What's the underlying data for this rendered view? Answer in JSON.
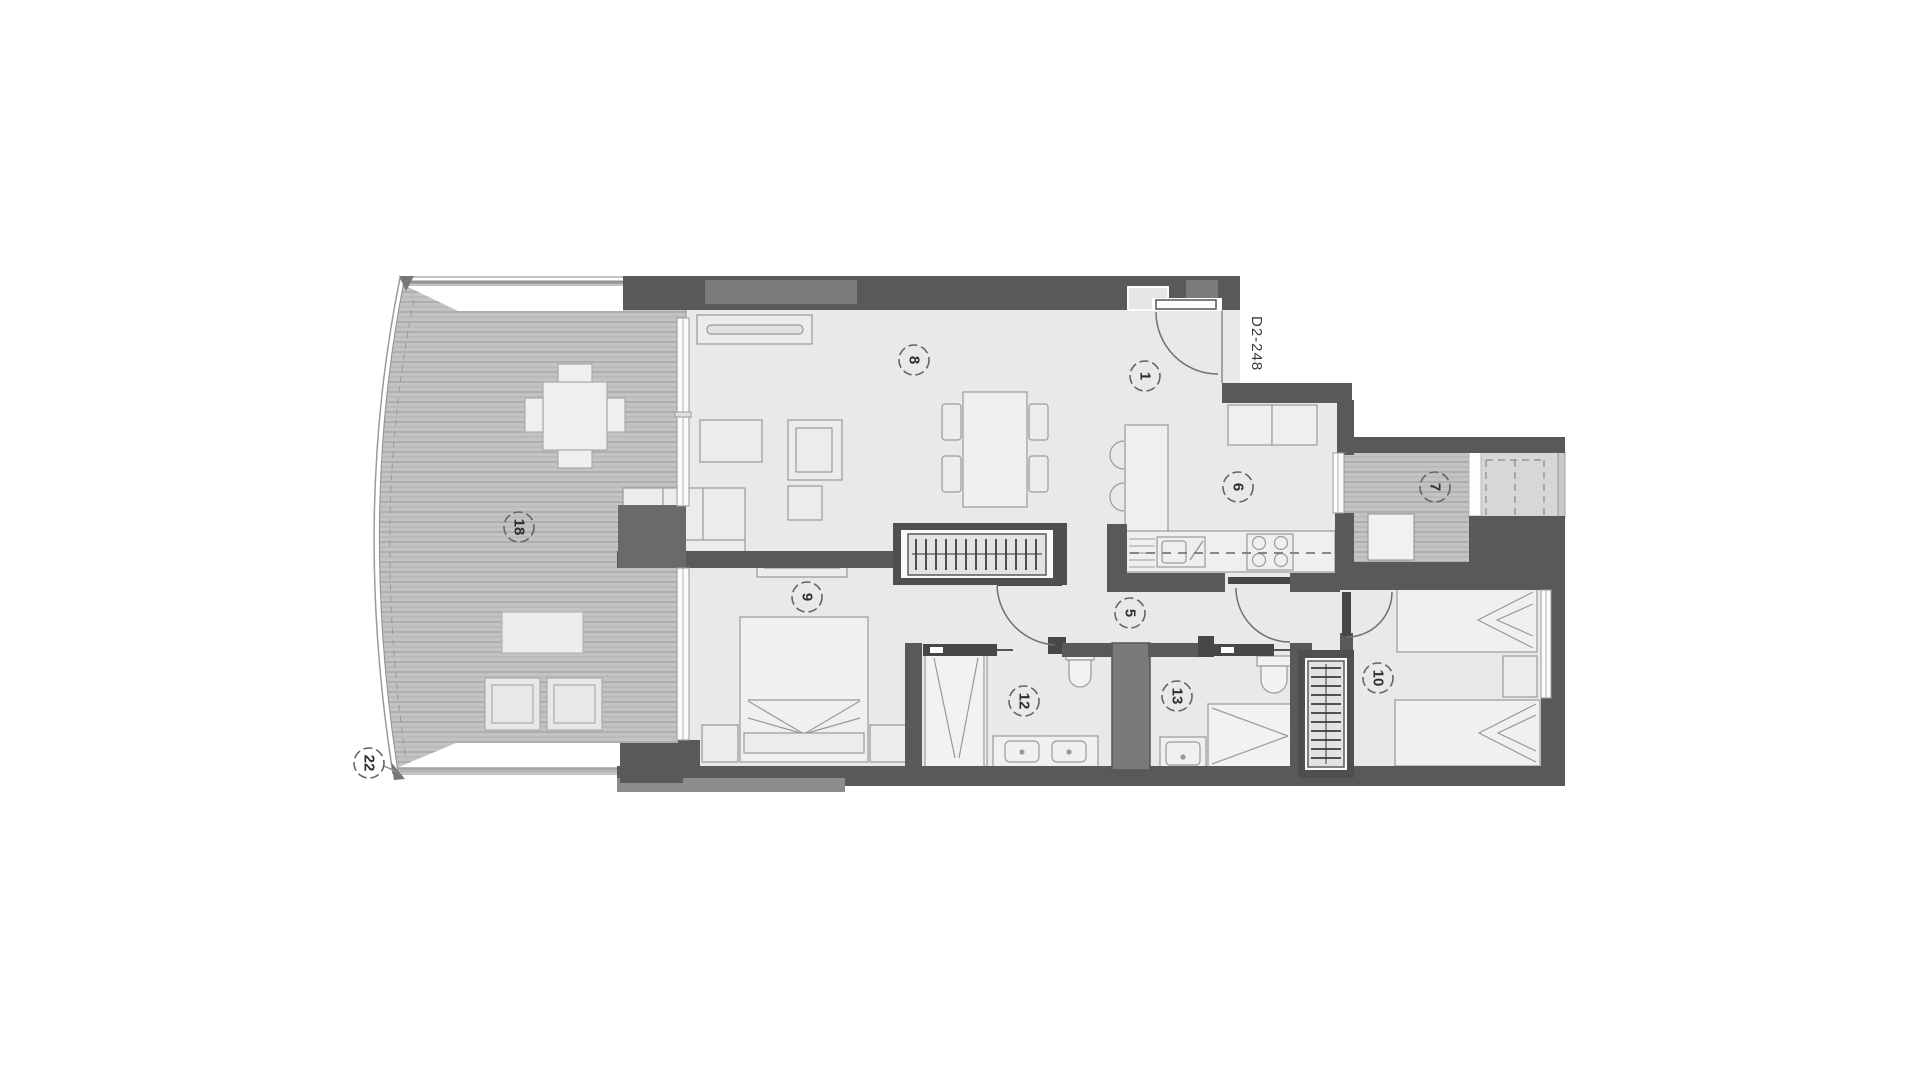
{
  "plan": {
    "unit_tag": "D2-248",
    "labels": [
      {
        "text": "18",
        "x": 519,
        "y": 527
      },
      {
        "text": "22",
        "x": 369,
        "y": 763
      },
      {
        "text": "8",
        "x": 914,
        "y": 360
      },
      {
        "text": "9",
        "x": 807,
        "y": 597
      },
      {
        "text": "1",
        "x": 1145,
        "y": 376
      },
      {
        "text": "5",
        "x": 1130,
        "y": 613
      },
      {
        "text": "6",
        "x": 1238,
        "y": 487
      },
      {
        "text": "12",
        "x": 1024,
        "y": 701
      },
      {
        "text": "13",
        "x": 1177,
        "y": 696
      },
      {
        "text": "7",
        "x": 1435,
        "y": 487
      },
      {
        "text": "10",
        "x": 1378,
        "y": 678
      }
    ],
    "colors": {
      "background": "#ffffff",
      "floor": "#e9e9e9",
      "wall_dark": "#595959",
      "wall_medium": "#7b7b7b",
      "deck_base": "#c3c3c3",
      "deck_line": "#989898",
      "adjacent_room": "#d7d7d7",
      "duct": "#7a7a7a",
      "furniture_fill": "#efefef",
      "furniture_stroke": "#9a9a9a",
      "label_stroke": "#646464",
      "label_text": "#2f2f2f"
    }
  }
}
